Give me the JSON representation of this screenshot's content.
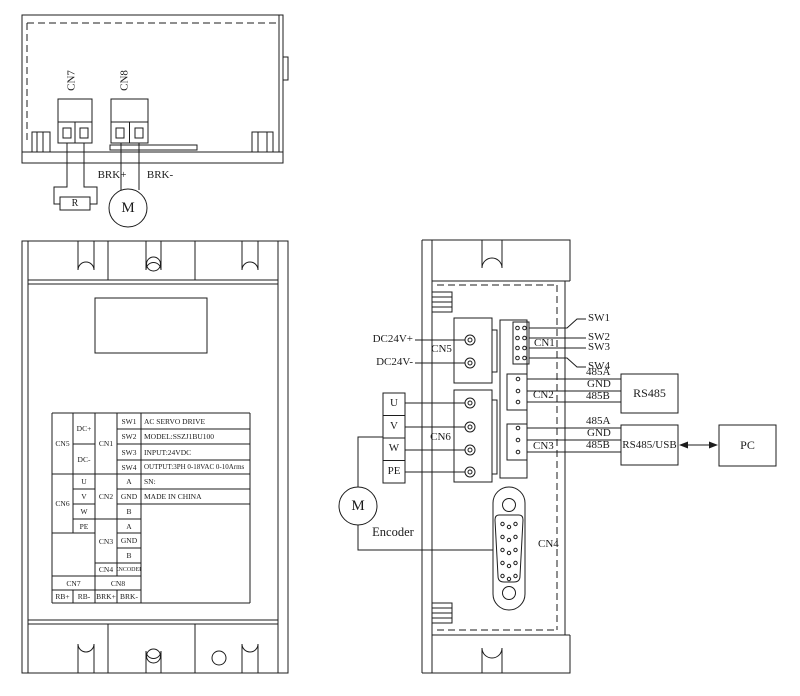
{
  "drawing": {
    "top_view": {
      "cn7": "CN7",
      "cn8": "CN8",
      "brk_plus": "BRK+",
      "brk_minus": "BRK-",
      "resistor": "R",
      "motor": "M"
    },
    "front_view": {
      "table": {
        "cn5": "CN5",
        "dc_plus": "DC+",
        "dc_minus": "DC-",
        "cn1": "CN1",
        "sw": [
          "SW1",
          "SW2",
          "SW3",
          "SW4"
        ],
        "info": [
          "AC SERVO DRIVE",
          "MODEL:SSZJ1BU100",
          "INPUT:24VDC",
          "OUTPUT:3PH 0-18VAC 0-10Arms",
          "SN:",
          "MADE IN CHINA"
        ],
        "cn6": "CN6",
        "u": "U",
        "v": "V",
        "w": "W",
        "pe": "PE",
        "cn2": "CN2",
        "cn2_pins": [
          "A",
          "GND",
          "B"
        ],
        "cn3": "CN3",
        "cn3_pins": [
          "A",
          "GND",
          "B"
        ],
        "cn4": "CN4",
        "cn4_pin": "ENCODER",
        "cn7": "CN7",
        "cn8": "CN8",
        "rb_plus": "RB+",
        "rb_minus": "RB-",
        "brk_plus": "BRK+",
        "brk_minus": "BRK-"
      }
    },
    "side_view": {
      "dc24v_plus": "DC24V+",
      "dc24v_minus": "DC24V-",
      "cn5": "CN5",
      "cn6": "CN6",
      "cn1": "CN1",
      "cn2": "CN2",
      "cn3": "CN3",
      "cn4": "CN4",
      "sw": [
        "SW1",
        "SW2",
        "SW3",
        "SW4"
      ],
      "cn2_wires": [
        "485A",
        "GND",
        "485B"
      ],
      "cn3_wires": [
        "485A",
        "GND",
        "485B"
      ],
      "rs485": "RS485",
      "rs485_usb": "RS485/USB",
      "pc": "PC",
      "u": "U",
      "v": "V",
      "w": "W",
      "pe": "PE",
      "motor": "M",
      "encoder": "Encoder"
    }
  }
}
